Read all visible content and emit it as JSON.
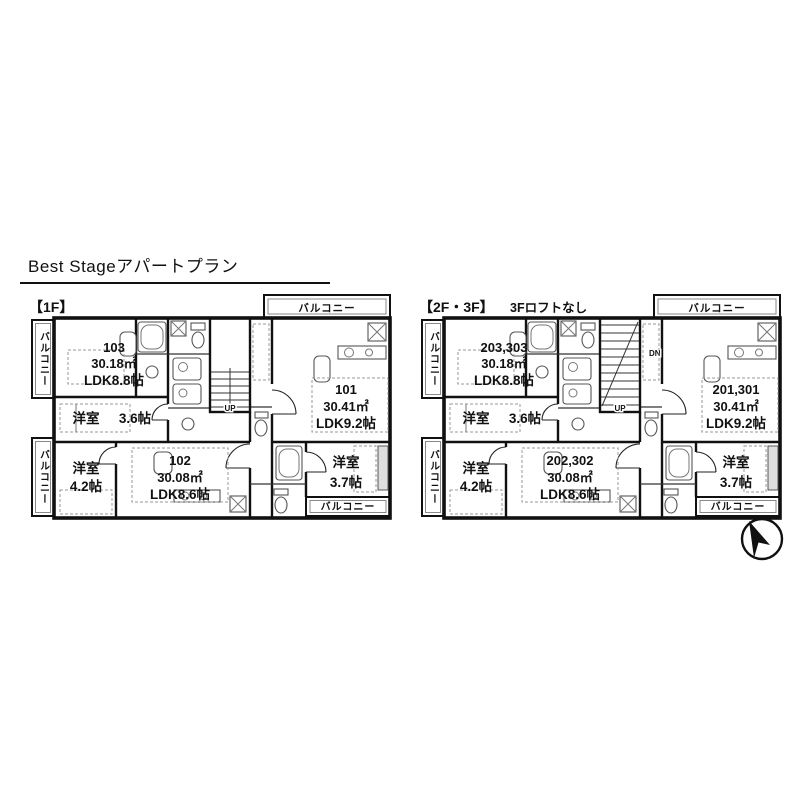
{
  "page": {
    "title": "Best Stageアパートプラン",
    "background": "#ffffff",
    "ink": "#111111"
  },
  "north_arrow": "compass needle pointing up-left",
  "plans": [
    {
      "header": "【1F】",
      "subheader": "",
      "balconies": {
        "top": "バルコニー",
        "bottom": "バルコニー",
        "left_upper": "バルコニー",
        "left_lower": "バルコニー"
      },
      "units": {
        "a": {
          "number": "103",
          "area": "30.18㎡",
          "ldk": "LDK8.8帖"
        },
        "b": {
          "number": "101",
          "area": "30.41㎡",
          "ldk": "LDK9.2帖"
        },
        "c": {
          "number": "102",
          "area": "30.08㎡",
          "ldk": "LDK8.6帖"
        }
      },
      "rooms": {
        "r36": {
          "name": "洋室",
          "size": "3.6帖"
        },
        "r42": {
          "name": "洋室",
          "size": "4.2帖"
        },
        "r37": {
          "name": "洋室",
          "size": "3.7帖"
        }
      },
      "stairs": {
        "top": "",
        "bottom": "UP"
      }
    },
    {
      "header": "【2F・3F】",
      "subheader": "3Fロフトなし",
      "balconies": {
        "top": "バルコニー",
        "bottom": "バルコニー",
        "left_upper": "バルコニー",
        "left_lower": "バルコニー"
      },
      "units": {
        "a": {
          "number": "203,303",
          "area": "30.18㎡",
          "ldk": "LDK8.8帖"
        },
        "b": {
          "number": "201,301",
          "area": "30.41㎡",
          "ldk": "LDK9.2帖"
        },
        "c": {
          "number": "202,302",
          "area": "30.08㎡",
          "ldk": "LDK8.6帖"
        }
      },
      "rooms": {
        "r36": {
          "name": "洋室",
          "size": "3.6帖"
        },
        "r42": {
          "name": "洋室",
          "size": "4.2帖"
        },
        "r37": {
          "name": "洋室",
          "size": "3.7帖"
        }
      },
      "stairs": {
        "top": "DN",
        "bottom": "UP"
      }
    }
  ]
}
